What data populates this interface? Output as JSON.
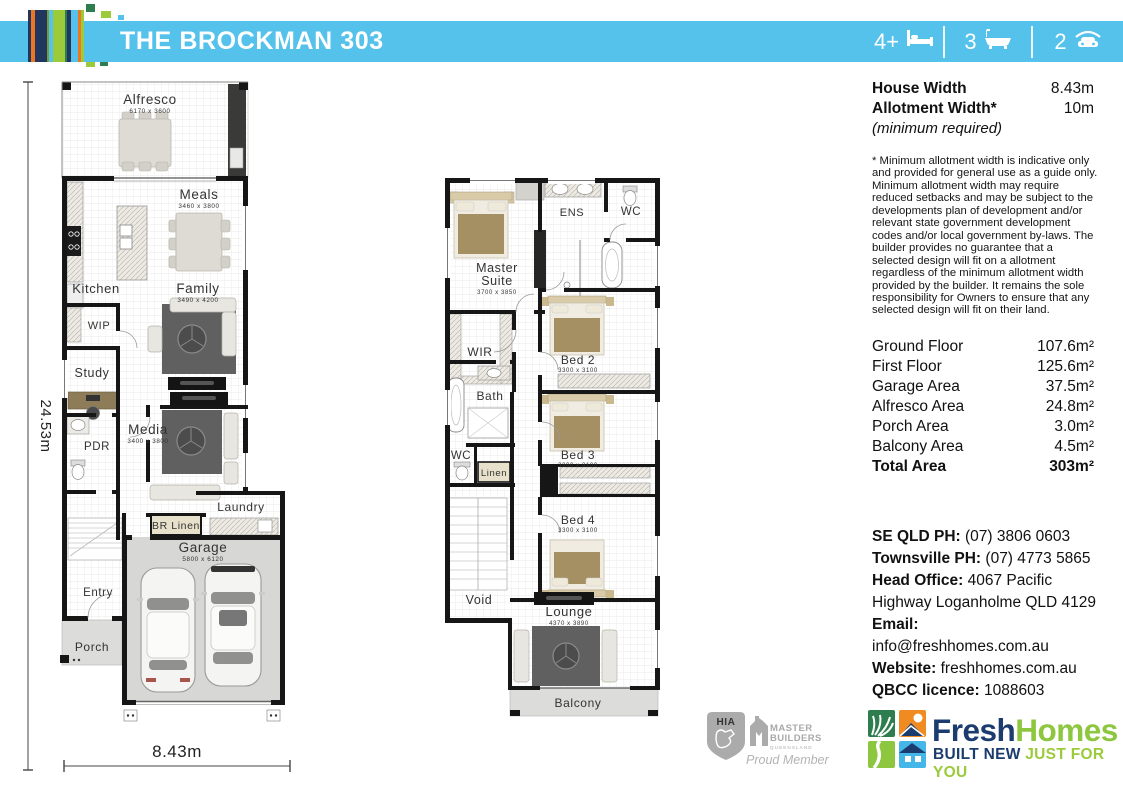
{
  "header": {
    "title": "THE BROCKMAN 303",
    "beds": "4+",
    "baths": "3",
    "cars": "2"
  },
  "dims": {
    "depth": "24.53m",
    "width": "8.43m"
  },
  "ground": {
    "alfresco": {
      "name": "Alfresco",
      "size": "6170 x 3600"
    },
    "meals": {
      "name": "Meals",
      "size": "3460 x 3800"
    },
    "kitchen": {
      "name": "Kitchen"
    },
    "family": {
      "name": "Family",
      "size": "3490 x 4200"
    },
    "wip": {
      "name": "WIP"
    },
    "study": {
      "name": "Study"
    },
    "pdr": {
      "name": "PDR"
    },
    "media": {
      "name": "Media",
      "size": "3400 x 3800"
    },
    "laundry": {
      "name": "Laundry"
    },
    "br_linen": {
      "name": "BR Linen"
    },
    "garage": {
      "name": "Garage",
      "size": "5800 x 6120"
    },
    "entry": {
      "name": "Entry"
    },
    "porch": {
      "name": "Porch"
    }
  },
  "first": {
    "master": {
      "line1": "Master",
      "line2": "Suite",
      "size": "3700 x 3850"
    },
    "ens": {
      "name": "ENS"
    },
    "wc_top": {
      "name": "WC"
    },
    "wir": {
      "name": "WIR"
    },
    "bed2": {
      "name": "Bed 2",
      "size": "3300 x 3100"
    },
    "bath": {
      "name": "Bath"
    },
    "wc_mid": {
      "name": "WC"
    },
    "linen": {
      "name": "Linen"
    },
    "bed3": {
      "name": "Bed 3",
      "size": "3300 x 3100"
    },
    "bed4": {
      "name": "Bed 4",
      "size": "3300 x 3100"
    },
    "void": {
      "name": "Void"
    },
    "lounge": {
      "name": "Lounge",
      "size": "4370 x 3890"
    },
    "balcony": {
      "name": "Balcony"
    }
  },
  "specs": {
    "house_width_label": "House Width",
    "house_width": "8.43m",
    "allotment_width_label": "Allotment Width*",
    "allotment_width": "10m",
    "minimum_note": "(minimum required)",
    "disclaimer": "* Minimum allotment width is indicative only and provided for general use as a guide only. Minimum allotment width may require reduced setbacks and may be subject to the developments plan of development and/or relevant state government development codes and/or local government by-laws. The builder provides no guarantee that a selected design will fit on a allotment regardless of the minimum allotment width provided by the builder. It remains the sole responsibility for Owners to ensure that any selected design will fit on their land."
  },
  "areas": {
    "ground_floor": {
      "label": "Ground Floor",
      "value": "107.6m²"
    },
    "first_floor": {
      "label": "First Floor",
      "value": "125.6m²"
    },
    "garage": {
      "label": "Garage Area",
      "value": "37.5m²"
    },
    "alfresco": {
      "label": "Alfresco Area",
      "value": "24.8m²"
    },
    "porch": {
      "label": "Porch Area",
      "value": "3.0m²"
    },
    "balcony": {
      "label": "Balcony Area",
      "value": "4.5m²"
    },
    "total": {
      "label": "Total Area",
      "value": "303m²"
    }
  },
  "contact": {
    "se_qld_label": "SE QLD PH:",
    "se_qld": "(07) 3806 0603",
    "townsville_label": "Townsville PH:",
    "townsville": "(07) 4773 5865",
    "head_office_label": "Head Office:",
    "head_office": "4067 Pacific Highway Loganholme QLD 4129",
    "email_label": "Email:",
    "email": "info@freshhomes.com.au",
    "website_label": "Website:",
    "website": "freshhomes.com.au",
    "qbcc_label": "QBCC licence:",
    "qbcc": "1088603"
  },
  "footer": {
    "hia_text": "HIA",
    "mb_line1": "MASTER",
    "mb_line2": "BUILDERS",
    "mb_line3": "QUEENSLAND",
    "proud_member": "Proud Member",
    "brand_fresh": "Fresh",
    "brand_homes": "Homes",
    "tagline_navy": "BUILT NEW",
    "tagline_green": "JUST FOR YOU"
  },
  "colors": {
    "accent_cyan": "#55C2EB",
    "stripe_navy": "#21375F",
    "stripe_orange": "#EE7623",
    "stripe_lime": "#9BCA3B",
    "logo_dark_green": "#2E7D4F",
    "brand_navy": "#1B3C6E",
    "brand_green": "#8DC63F",
    "logo_blue": "#45B6E8"
  }
}
